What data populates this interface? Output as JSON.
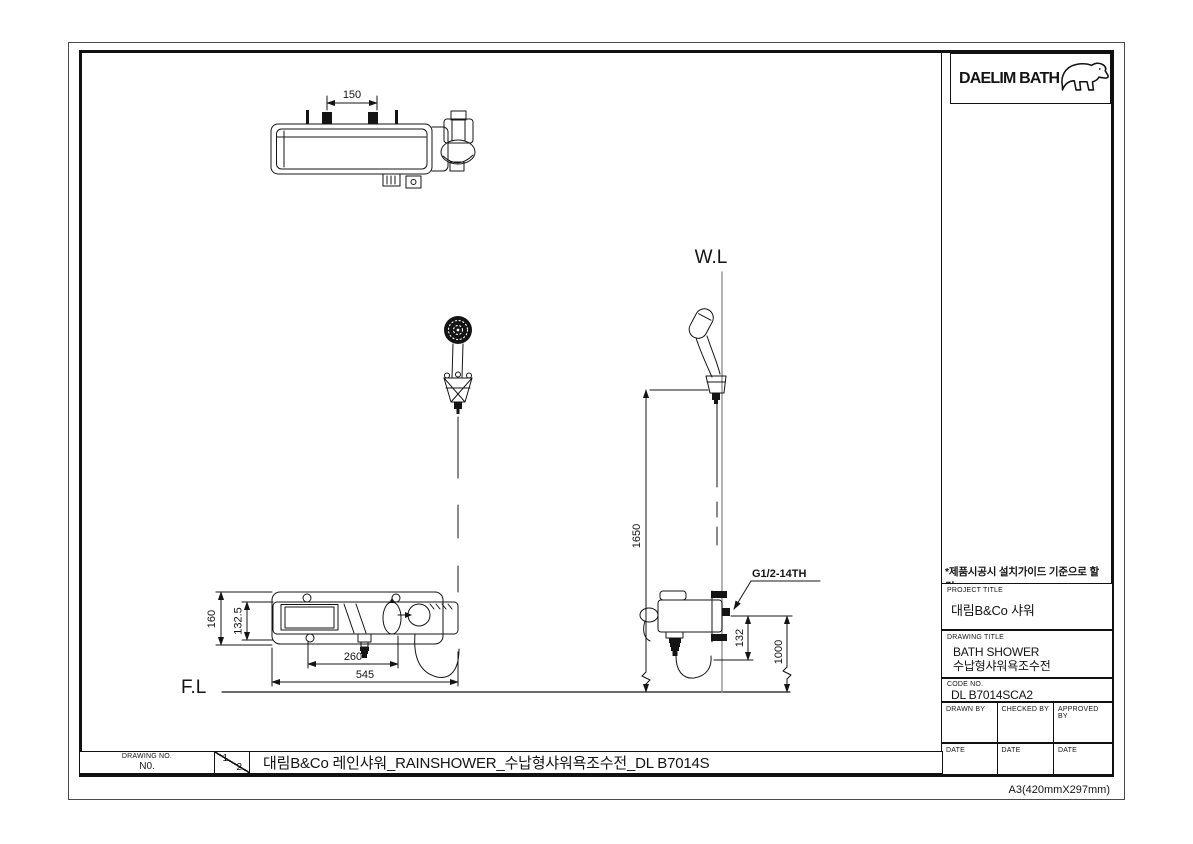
{
  "paper_label": "A3(420mmX297mm)",
  "logo": {
    "brand_text": "DAELIM BATH"
  },
  "note": "*제품시공시 설치가이드 기준으로 할 것.",
  "title_block": {
    "project_title_label": "PROJECT TITLE",
    "project_title": "대림B&Co 샤워",
    "drawing_title_label": "DRAWING TITLE",
    "drawing_title_line1": "BATH SHOWER",
    "drawing_title_line2": "수납형샤워욕조수전",
    "code_no_label": "CODE NO.",
    "code_no": "DL B7014SCA2",
    "drawn_by_label": "DRAWN BY",
    "checked_by_label": "CHECKED BY",
    "approved_by_label": "APPROVED BY",
    "date_label": "DATE"
  },
  "footer": {
    "drawing_no_label": "DRAWING NO.",
    "drawing_no_value": "N0.",
    "sheet_current": "1",
    "sheet_total": "2",
    "title": "대림B&Co 레인샤워_RAINSHOWER_수납형샤워욕조수전_DL B7014S"
  },
  "drawing": {
    "wl_label": "W.L",
    "fl_label": "F.L",
    "thread_label": "G1/2-14TH",
    "dims": {
      "top_inlet_spacing": "150",
      "front_total_height": "160",
      "front_body_height": "132.5",
      "front_inner_width": "260",
      "front_total_width": "545",
      "side_shower_height": "1650",
      "side_offset": "132",
      "side_outlet_height": "1000"
    }
  },
  "colors": {
    "line": "#141414",
    "wall_line": "#8a8a8a"
  }
}
